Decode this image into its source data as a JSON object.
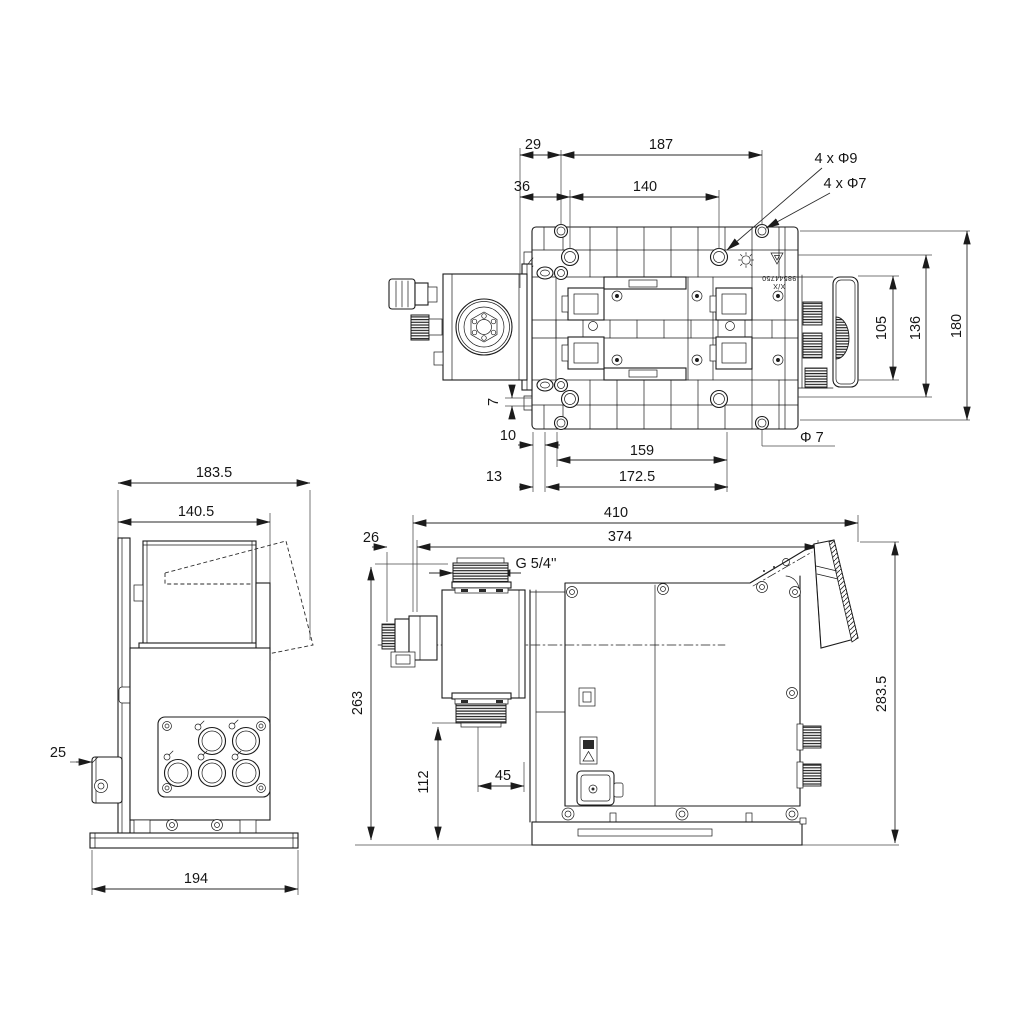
{
  "drawing": {
    "background": "#ffffff",
    "ink": "#1b1b1b",
    "views": {
      "top": {
        "title": "top view",
        "dims": {
          "d29": "29",
          "d187": "187",
          "d36": "36",
          "d140": "140",
          "d105": "105",
          "d136": "136",
          "d180": "180",
          "d7": "7",
          "d10": "10",
          "d159": "159",
          "d172_5": "172.5",
          "d13": "13"
        },
        "callouts": {
          "holes9": "4 x Φ9",
          "holes7": "4 x Φ7",
          "dia7": "Φ 7"
        },
        "part_label": {
          "line1": "X/X",
          "line2": "98544750"
        }
      },
      "side": {
        "title": "left side view",
        "dims": {
          "d183_5": "183.5",
          "d140_5": "140.5",
          "d25": "25",
          "d194": "194"
        }
      },
      "front": {
        "title": "front view",
        "dims": {
          "d410": "410",
          "d26": "26",
          "d374": "374",
          "d263": "263",
          "d112": "112",
          "d45": "45",
          "d283_5": "283.5"
        },
        "callouts": {
          "thread": "G 5/4''"
        }
      }
    }
  }
}
